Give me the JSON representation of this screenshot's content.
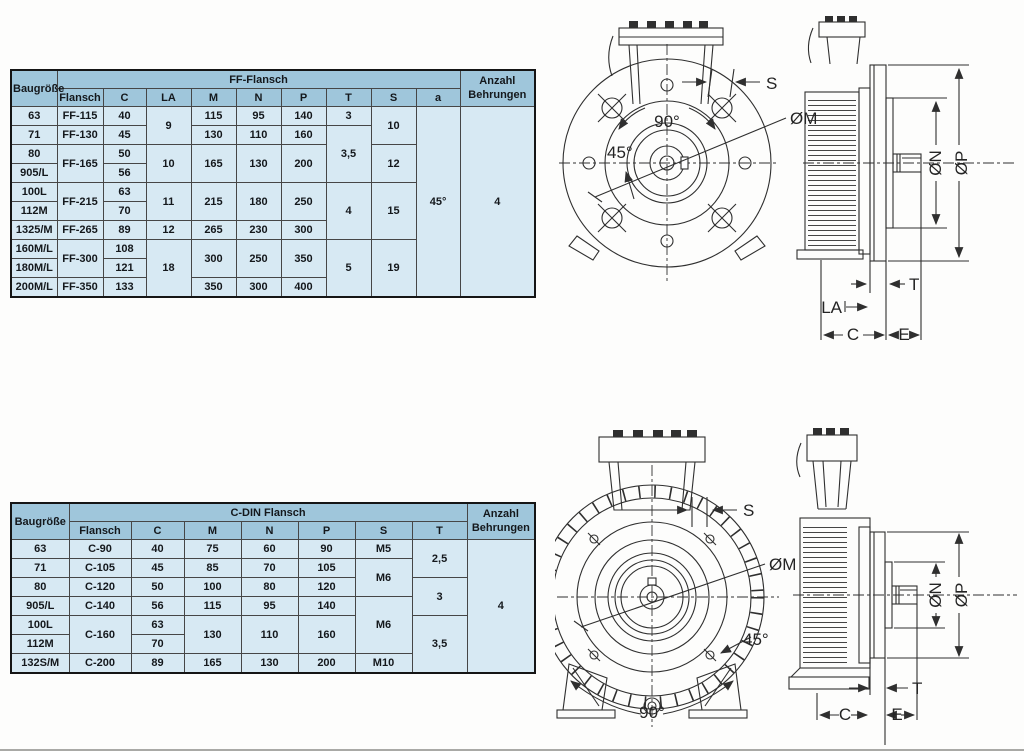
{
  "colors": {
    "table_header_bg": "#9fc6db",
    "table_cell_bg": "#d7e9f3",
    "grid_line": "#464646",
    "outer_border": "#151515",
    "ink": "#14181c",
    "drawing_line": "#2f2f2f",
    "paper": "#fdfdfc"
  },
  "ff": {
    "header": {
      "baugroesse": "Baugröße",
      "group": "FF-Flansch",
      "flansch": "Flansch",
      "c": "C",
      "la": "LA",
      "m": "M",
      "n": "N",
      "p": "P",
      "t": "T",
      "s": "S",
      "a": "a",
      "anzahl1": "Anzahl",
      "anzahl2": "Behrungen"
    },
    "rows": [
      {
        "bg": "63",
        "fl": "FF-115",
        "c": "40",
        "la": "9",
        "m": "115",
        "n": "95",
        "p": "140",
        "t": "3",
        "s": "10",
        "a": "45°",
        "anz": "4"
      },
      {
        "bg": "71",
        "fl": "FF-130",
        "c": "45",
        "m": "130",
        "n": "110",
        "p": "160",
        "t": "3,5"
      },
      {
        "bg": "80",
        "fl": "FF-165",
        "c": "50",
        "la": "10",
        "m": "165",
        "n": "130",
        "p": "200",
        "s": "12"
      },
      {
        "bg": "905/L",
        "c": "56"
      },
      {
        "bg": "100L",
        "fl": "FF-215",
        "c": "63",
        "la": "11",
        "m": "215",
        "n": "180",
        "p": "250",
        "t": "4",
        "s": "15"
      },
      {
        "bg": "112M",
        "c": "70"
      },
      {
        "bg": "1325/M",
        "fl": "FF-265",
        "c": "89",
        "la": "12",
        "m": "265",
        "n": "230",
        "p": "300"
      },
      {
        "bg": "160M/L",
        "fl": "FF-300",
        "c": "108",
        "la": "18",
        "m": "300",
        "n": "250",
        "p": "350",
        "t": "5",
        "s": "19"
      },
      {
        "bg": "180M/L",
        "c": "121"
      },
      {
        "bg": "200M/L",
        "fl": "FF-350",
        "c": "133",
        "m": "350",
        "n": "300",
        "p": "400"
      }
    ],
    "drawing_labels": {
      "s": "S",
      "m": "ØM",
      "a90": "90°",
      "a45": "45°",
      "n": "ØN",
      "p": "ØP",
      "t": "T",
      "la": "LA",
      "c": "C",
      "e": "E"
    }
  },
  "cdin": {
    "header": {
      "baugroesse": "Baugröße",
      "group": "C-DIN Flansch",
      "flansch": "Flansch",
      "c": "C",
      "m": "M",
      "n": "N",
      "p": "P",
      "s": "S",
      "t": "T",
      "anzahl1": "Anzahl",
      "anzahl2": "Behrungen"
    },
    "rows": [
      {
        "bg": "63",
        "fl": "C-90",
        "c": "40",
        "m": "75",
        "n": "60",
        "p": "90",
        "s": "M5",
        "t": "2,5",
        "anz": "4"
      },
      {
        "bg": "71",
        "fl": "C-105",
        "c": "45",
        "m": "85",
        "n": "70",
        "p": "105",
        "s": "M6"
      },
      {
        "bg": "80",
        "fl": "C-120",
        "c": "50",
        "m": "100",
        "n": "80",
        "p": "120",
        "t": "3"
      },
      {
        "bg": "905/L",
        "fl": "C-140",
        "c": "56",
        "m": "115",
        "n": "95",
        "p": "140",
        "s": "M6"
      },
      {
        "bg": "100L",
        "fl": "C-160",
        "c": "63",
        "m": "130",
        "n": "110",
        "p": "160",
        "t": "3,5"
      },
      {
        "bg": "112M",
        "c": "70"
      },
      {
        "bg": "132S/M",
        "fl": "C-200",
        "c": "89",
        "m": "165",
        "n": "130",
        "p": "200",
        "s": "M10"
      }
    ],
    "drawing_labels": {
      "s": "S",
      "m": "ØM",
      "a45": "45°",
      "a90": "90°",
      "n": "ØN",
      "p": "ØP",
      "t": "T",
      "c": "C",
      "e": "E"
    }
  }
}
